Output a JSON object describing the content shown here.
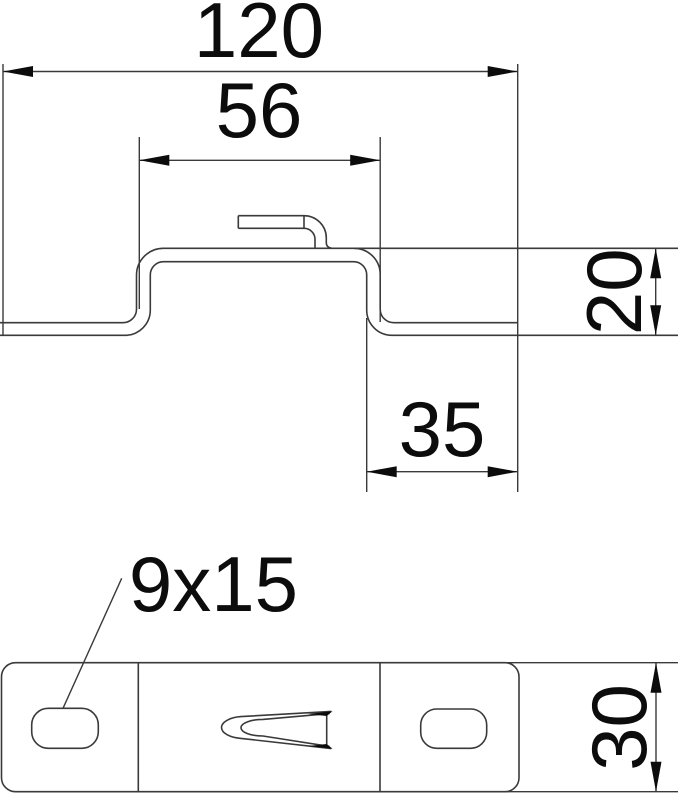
{
  "colors": {
    "background": "#ffffff",
    "line": "#3a3a3a",
    "ink": "#0c0c0c"
  },
  "section_view": {
    "view_name": "profile-cross-section",
    "dim_overall_width": "120",
    "dim_top_flange_width": "56",
    "dim_profile_height": "20",
    "dim_end_flange_length": "35"
  },
  "plan_view": {
    "view_name": "bottom-plan-view",
    "dim_plate_height": "30",
    "slot_callout": "9x15"
  }
}
